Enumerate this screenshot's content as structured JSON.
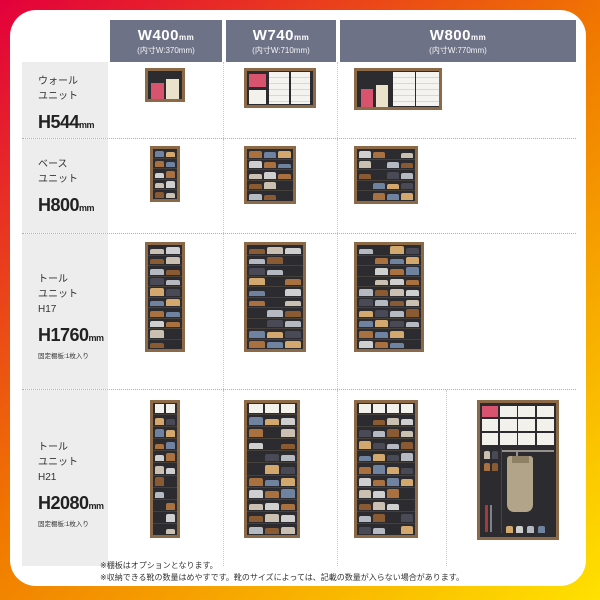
{
  "colors": {
    "gradient_top": "#e3003c",
    "gradient_mid": "#f07800",
    "gradient_bottom": "#ffe100",
    "header_bg": "#6e7287",
    "label_bg": "#ededed",
    "badge_bg": "#1a1a1a",
    "wood": "#8c6a48",
    "interior": "#2b2b30",
    "accent_pink": "#d8536e",
    "shoe_palette": [
      "#cfcfcf",
      "#a9713f",
      "#6f82a0",
      "#d2a86e",
      "#494a55",
      "#b5b9c2",
      "#8a5a33",
      "#c9c0b2"
    ]
  },
  "badge_label": "靴",
  "header": {
    "columns": [
      {
        "size": "W400",
        "unit": "mm",
        "inner": "(内寸W:370mm)"
      },
      {
        "size": "W740",
        "unit": "mm",
        "inner": "(内寸W:710mm)"
      },
      {
        "size": "W800",
        "unit": "mm",
        "inner": "(内寸W:770mm)"
      }
    ]
  },
  "rows": [
    {
      "label": {
        "lines": [
          "ウォール",
          "ユニット"
        ],
        "height": "H544",
        "height_unit": "mm",
        "note": ""
      },
      "cells": [
        {
          "count": "4〜8",
          "suffix": "足",
          "note": "",
          "cab": {
            "kind": "wall",
            "variant": 1,
            "w": 40,
            "h": 34
          }
        },
        {
          "count": "6〜12",
          "suffix": "足",
          "note": "",
          "cab": {
            "kind": "wall",
            "variant": 2,
            "w": 72,
            "h": 40
          }
        },
        {
          "count": "8〜16",
          "suffix": "足",
          "note": "",
          "cab": {
            "kind": "wall",
            "variant": 3,
            "w": 88,
            "h": 42
          }
        }
      ]
    },
    {
      "label": {
        "lines": [
          "ベース",
          "ユニット"
        ],
        "height": "H800",
        "height_unit": "mm",
        "note": ""
      },
      "cells": [
        {
          "count": "10",
          "suffix": "足",
          "note": "棚板4枚入り",
          "cab": {
            "kind": "shoes",
            "w": 30,
            "h": 56,
            "shelves": 5,
            "cols": 2
          }
        },
        {
          "count": "15",
          "suffix": "足",
          "note": "棚板4枚入り",
          "cab": {
            "kind": "shoes",
            "w": 52,
            "h": 58,
            "shelves": 5,
            "cols": 3
          }
        },
        {
          "count": "20",
          "suffix": "足",
          "note": "棚板4枚入り",
          "cab": {
            "kind": "shoes",
            "w": 64,
            "h": 58,
            "shelves": 5,
            "cols": 4
          }
        }
      ]
    },
    {
      "label": {
        "lines": [
          "トール",
          "ユニット",
          "H17"
        ],
        "height": "H1760",
        "height_unit": "mm",
        "note": "固定棚板:1枚入り"
      },
      "cells": [
        {
          "count": "22",
          "suffix": "足",
          "note": "棚板9枚入り",
          "cab": {
            "kind": "shoes",
            "w": 40,
            "h": 110,
            "shelves": 10,
            "cols": 2
          }
        },
        {
          "count": "33",
          "suffix": "足",
          "note": "棚板9枚入り",
          "cab": {
            "kind": "shoes",
            "w": 62,
            "h": 110,
            "shelves": 10,
            "cols": 3
          }
        },
        {
          "count": "44",
          "suffix": "足",
          "note": "棚板9枚入り",
          "cab": {
            "kind": "shoes",
            "w": 70,
            "h": 110,
            "shelves": 10,
            "cols": 4
          }
        }
      ]
    },
    {
      "label": {
        "lines": [
          "トール",
          "ユニット",
          "H21"
        ],
        "height": "H2080",
        "height_unit": "mm",
        "note": "固定棚板:1枚入り"
      },
      "cells": [
        {
          "count": "26",
          "suffix": "足",
          "note": "棚板9枚+2枚入り",
          "cab": {
            "kind": "shoes",
            "w": 30,
            "h": 138,
            "shelves": 11,
            "cols": 2,
            "box_top": true
          }
        },
        {
          "count": "39",
          "suffix": "足",
          "note": "棚板9枚+2枚入り",
          "cab": {
            "kind": "shoes",
            "w": 56,
            "h": 138,
            "shelves": 11,
            "cols": 3,
            "box_top": true
          }
        },
        {
          "count": "52",
          "suffix": "足",
          "note": "棚板9枚+2枚入り",
          "cab": {
            "kind": "shoes",
            "w": 64,
            "h": 138,
            "shelves": 11,
            "cols": 4,
            "box_top": true
          }
        },
        {
          "count": "21",
          "suffix": "足",
          "note_lines": [
            "中仕切り仕様",
            "棚板 W020 2枚入り",
            "棚板 W060 2枚入り",
            "棚板 W080 2枚入り",
            "コートハンガー"
          ],
          "cab": {
            "kind": "coat",
            "w": 82,
            "h": 140
          }
        }
      ]
    }
  ],
  "footnotes": [
    "※棚板はオプションとなります。",
    "※収納できる靴の数量はめやすです。靴のサイズによっては、記載の数量が入らない場合があります。"
  ]
}
